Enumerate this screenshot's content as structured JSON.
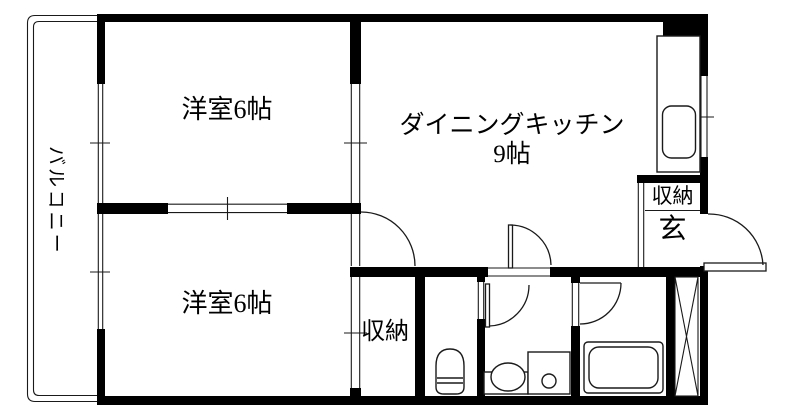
{
  "floorplan": {
    "type": "apartment-floor-plan",
    "rooms": {
      "western_top": {
        "label": "洋室6帖"
      },
      "dining_kitchen": {
        "label": "ダイニングキッチン",
        "size": "9帖"
      },
      "western_bottom": {
        "label": "洋室6帖"
      },
      "hall_closet": {
        "label": "収納"
      },
      "entry_closet": {
        "label": "収納"
      },
      "entry": {
        "label": "玄"
      },
      "balcony": {
        "label": "バルコニー"
      }
    },
    "fixtures": [
      "kitchen-sink",
      "toilet",
      "washbasin",
      "washing-machine-pan",
      "bathtub",
      "pipe-shaft"
    ],
    "colors": {
      "walls": "#000000",
      "lines": "#1a1a1a",
      "background": "#ffffff"
    }
  }
}
